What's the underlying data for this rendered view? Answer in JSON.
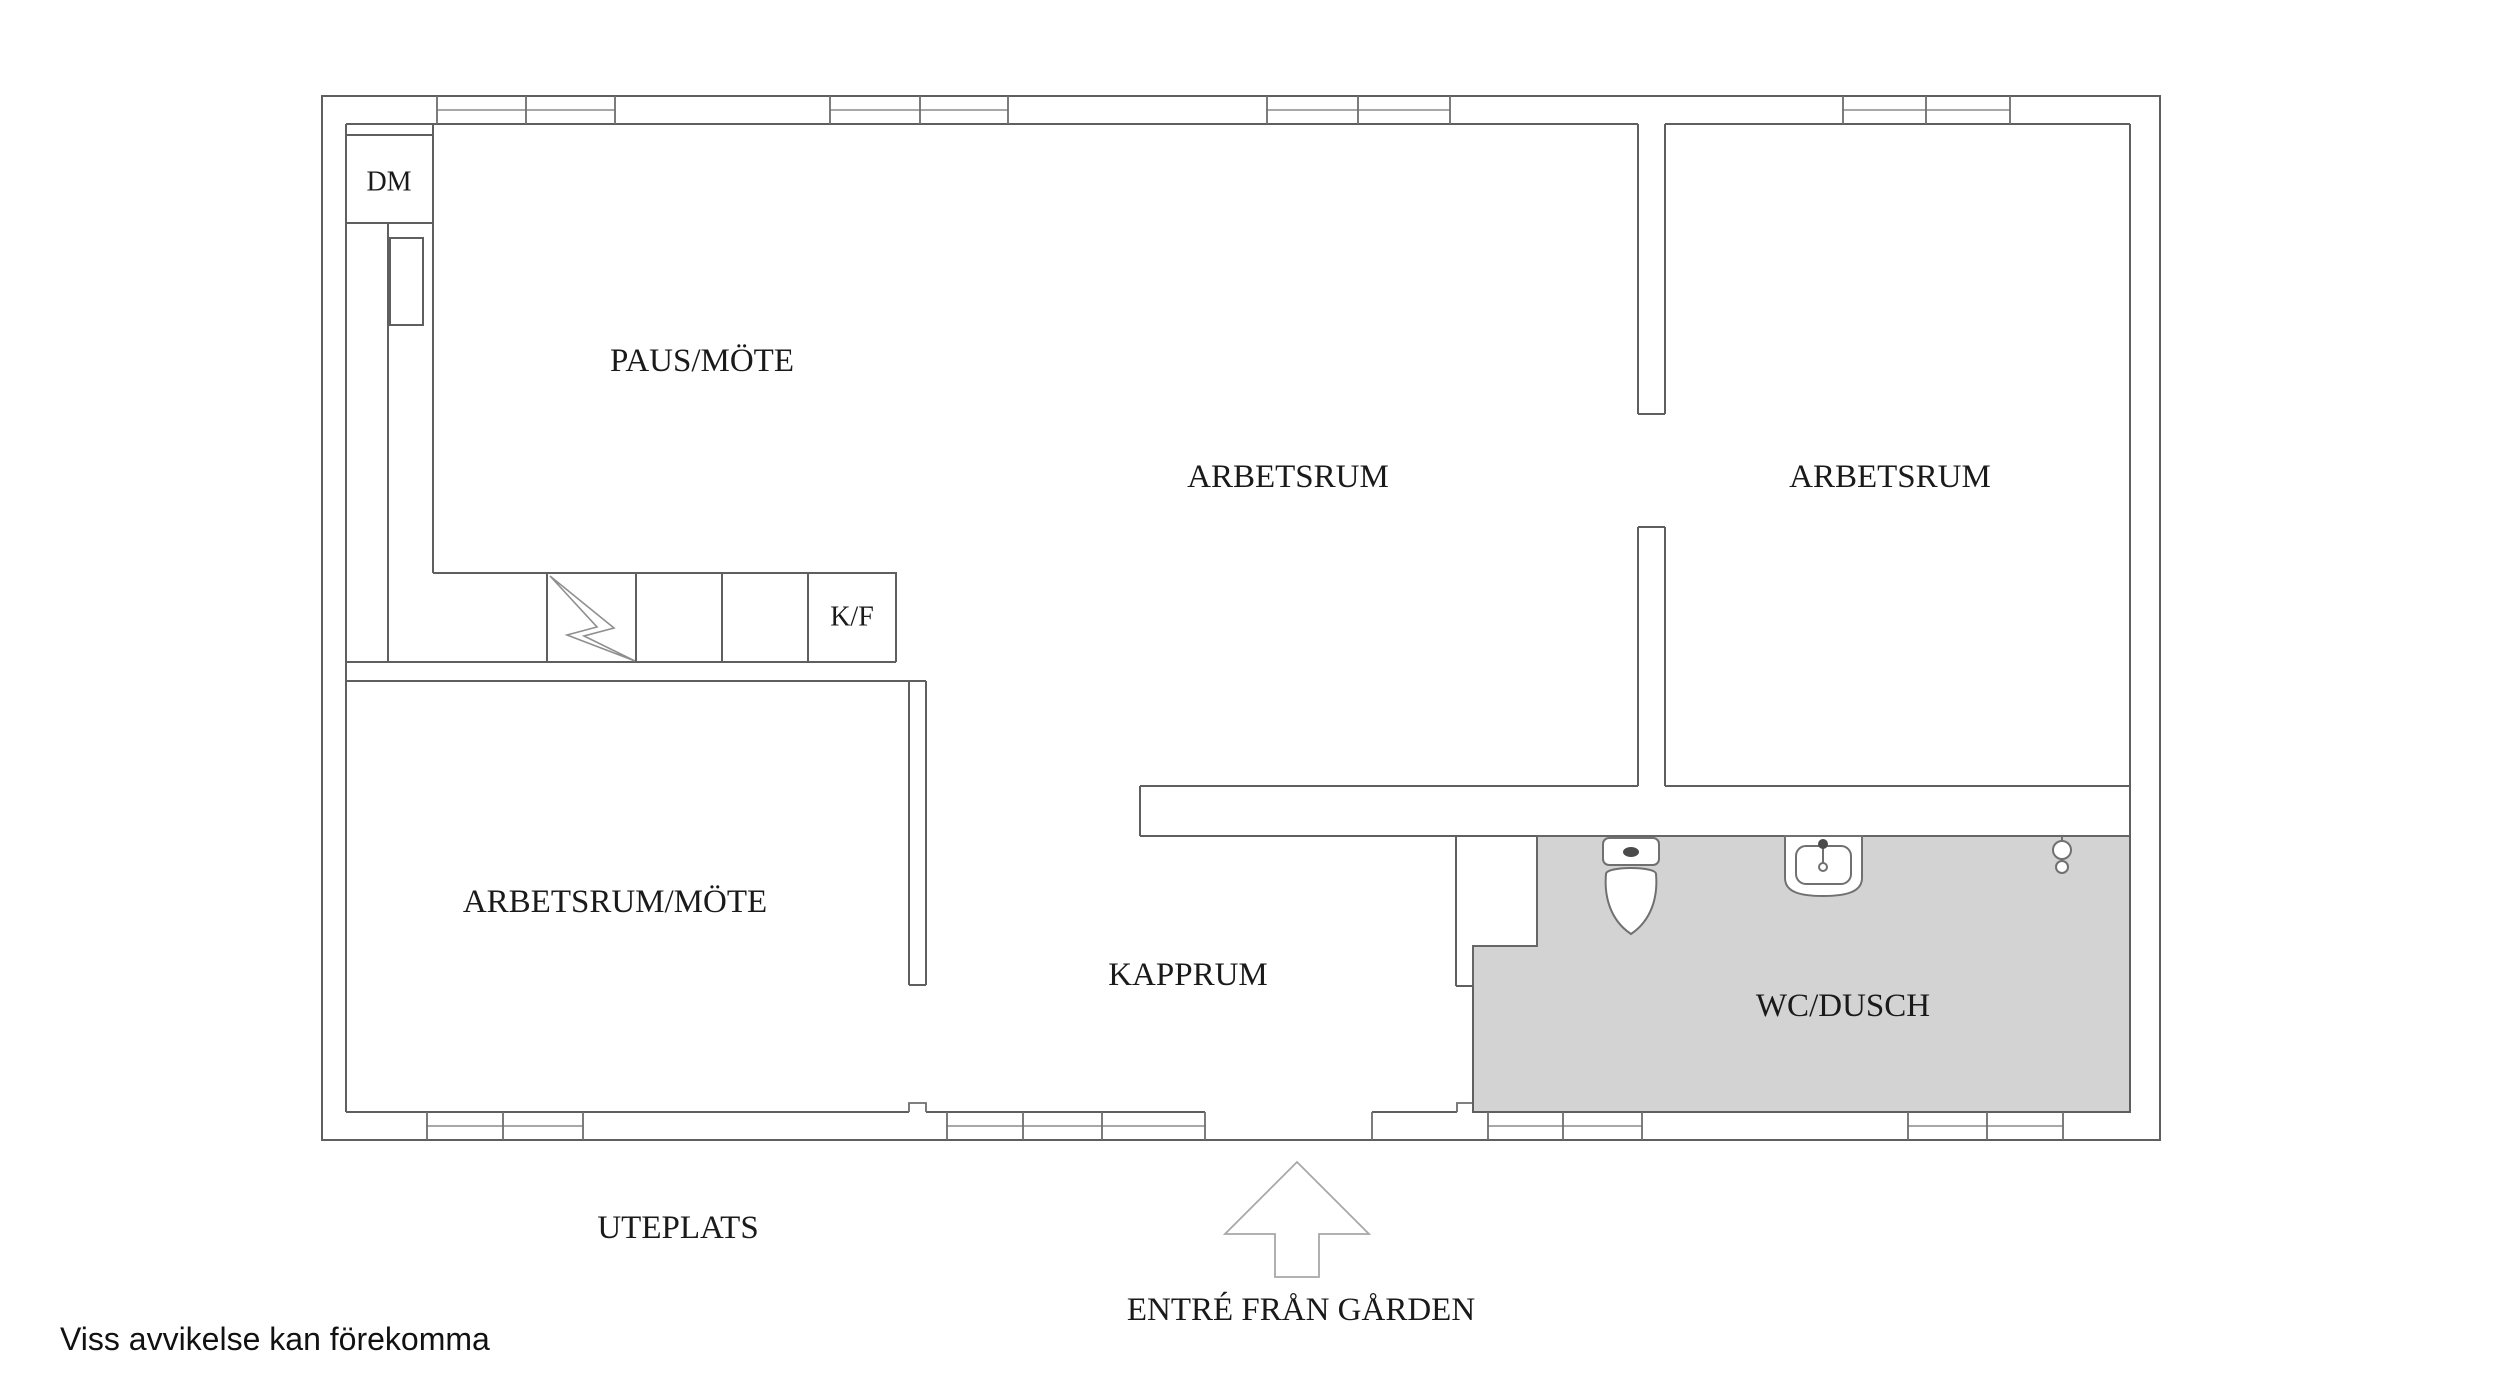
{
  "floorplan": {
    "rooms": {
      "dm": {
        "label": "DM"
      },
      "paus_mote": {
        "label": "PAUS/MÖTE"
      },
      "arbetsrum_1": {
        "label": "ARBETSRUM"
      },
      "arbetsrum_2": {
        "label": "ARBETSRUM"
      },
      "kf": {
        "label": "K/F"
      },
      "arbetsrum_mote": {
        "label": "ARBETSRUM/MÖTE"
      },
      "kapprum": {
        "label": "KAPPRUM"
      },
      "wc_dusch": {
        "label": "WC/DUSCH"
      }
    },
    "outdoor": {
      "patio_label": "UTEPLATS",
      "entrance_label": "ENTRÉ FRÅN GÅRDEN"
    },
    "disclaimer": "Viss avvikelse kan förekomma",
    "symbols": {
      "toilet": "toilet-symbol",
      "sink": "sink-symbol",
      "shower": "shower-symbol",
      "electric": "lightning-bolt-symbol",
      "entrance_arrow": "entrance-arrow-icon"
    },
    "colors": {
      "wall_line": "#5f5f5f",
      "wet_room_fill": "#d3d3d3",
      "label_text": "#1a1a1a",
      "arrow_line": "#a8a8a8",
      "background": "#ffffff"
    }
  }
}
